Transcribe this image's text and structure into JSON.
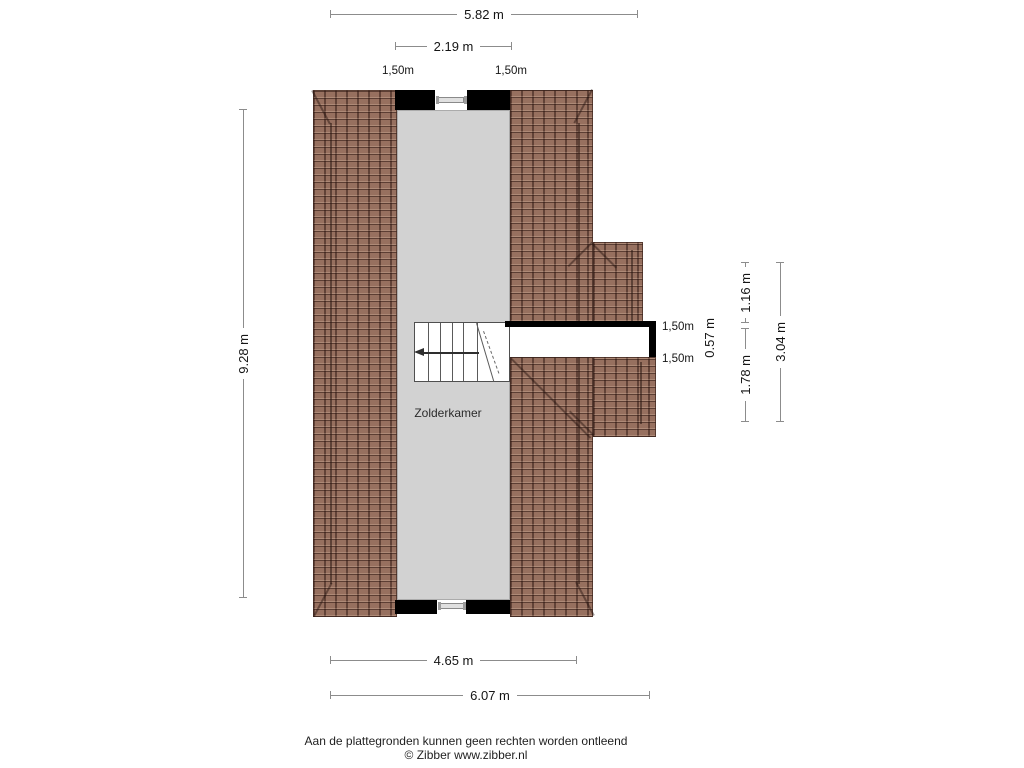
{
  "plan": {
    "room": {
      "label": "Zolderkamer"
    },
    "dims": {
      "top_width_total": "5.82 m",
      "top_width_inner": "2.19 m",
      "knee_top_left": "1,50m",
      "knee_top_right": "1,50m",
      "side_height_total": "9.28 m",
      "right_seg_upper": "1.16 m",
      "right_seg_lower": "1.78 m",
      "right_seg_total": "3.04 m",
      "passage_width": "0.57 m",
      "knee_right_upper": "1,50m",
      "knee_right_lower": "1,50m",
      "bottom_width_inner": "4.65 m",
      "bottom_width_total": "6.07 m"
    },
    "colors": {
      "roof_tile": "#97705f",
      "room_fill": "#d2d2d2",
      "wall": "#000000",
      "dimension_line": "#8c8c8c"
    }
  },
  "footer": {
    "disclaimer": "Aan de plattegronden kunnen geen rechten worden ontleend",
    "copyright": "© Zibber www.zibber.nl"
  }
}
